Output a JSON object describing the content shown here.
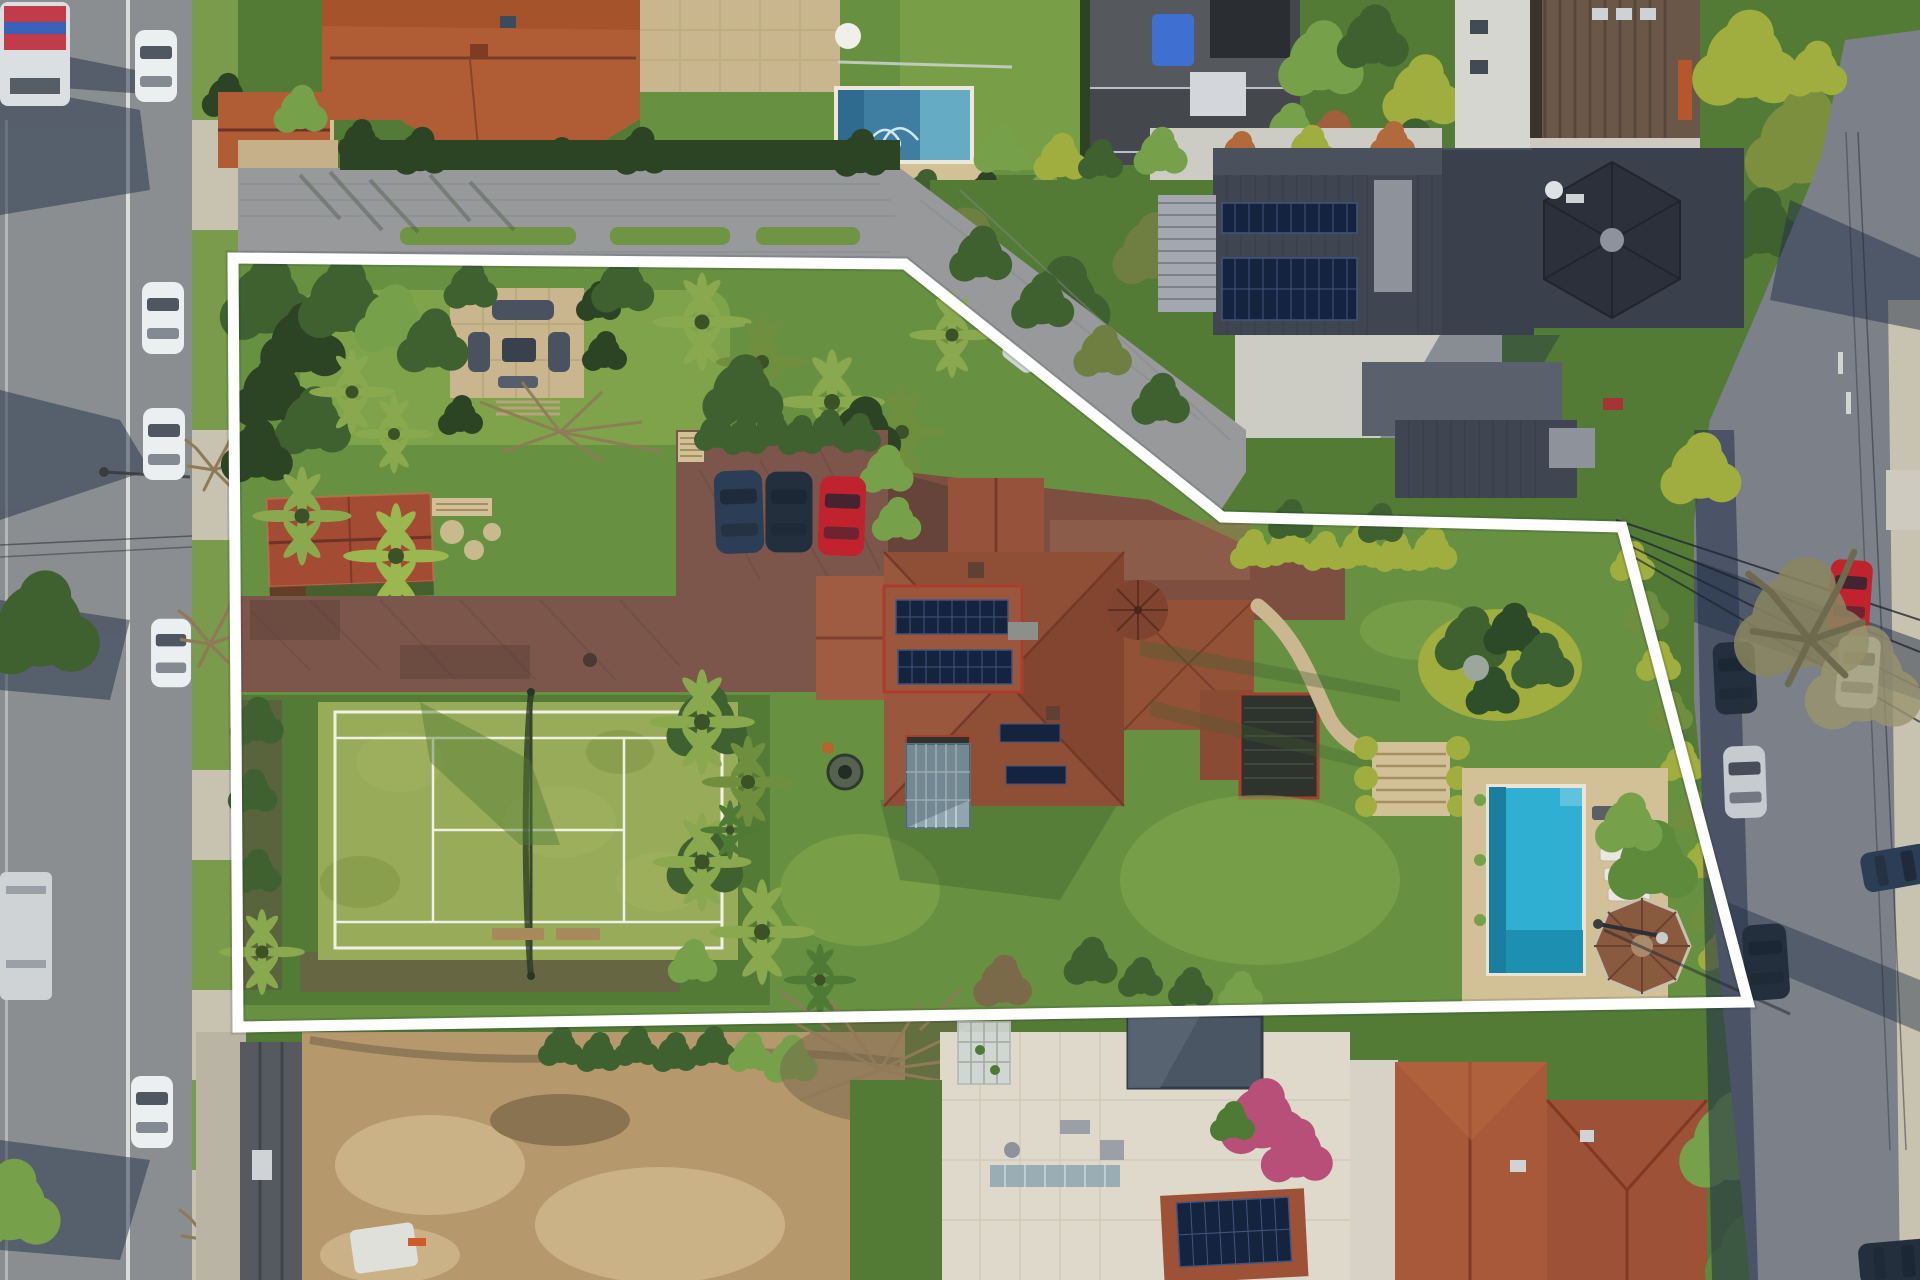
{
  "scene": {
    "type": "aerial-drone-photograph",
    "subject": "large suburban estate with grass tennis court, terracotta-roof mansion, swimming pool and gardens, flanked by streets with parked cars",
    "overlay_meaning": "white outline marking the property boundary"
  },
  "boundary": {
    "points": "233,258 905,264 1222,517 1622,527 1748,1002 238,1027",
    "closed": true,
    "stroke_width": 11
  },
  "features": [
    {
      "name": "front-lawn-patio",
      "desc": "stone patio with grey outdoor lounge furniture on upper lawn"
    },
    {
      "name": "cottage",
      "desc": "small terracotta-roof garden cottage"
    },
    {
      "name": "parking-court",
      "desc": "paved parking with dark blue, black and red cars"
    },
    {
      "name": "tennis-court",
      "desc": "grass tennis court with white lines and net"
    },
    {
      "name": "mansion",
      "desc": "terracotta tiled mansion with rooftop solar arrays, conservatory and dark veranda"
    },
    {
      "name": "estate-pool",
      "desc": "turquoise pool with spa edge, sun loungers and octagonal gazebo"
    },
    {
      "name": "modern-house",
      "desc": "charcoal modern neighbour house with two solar arrays and hexagonal turret"
    },
    {
      "name": "neighbor-pool",
      "desc": "neighbour pool at top of frame"
    },
    {
      "name": "dirt-lot",
      "desc": "cleared sandy lot below the estate"
    },
    {
      "name": "left-road",
      "desc": "street with white parked cars and tree shadows"
    },
    {
      "name": "right-road",
      "desc": "shaded street with parked cars, power lines and street lamp"
    }
  ],
  "palette": {
    "white_line": "#ffffff",
    "asphalt": "#8b8e90",
    "asphalt_dark": "#7b8089",
    "sidewalk": "#c8c2b0",
    "concrete": "#cdccc4",
    "lawn": "#679140",
    "lawn_bright": "#84a74e",
    "lawn_dark": "#537b35",
    "court_grass": "#97ab58",
    "court_line": "#f0f1e6",
    "hedge_dark": "#2d4424",
    "tree_green": "#3f6130",
    "tree_bright": "#76a04a",
    "tree_yellow": "#9fae3e",
    "palm_green": "#8aa84e",
    "terracotta": "#b05d36",
    "terracotta_dark": "#8f4e36",
    "roof_ridge": "#6d3425",
    "cottage_roof": "#a34b33",
    "modern_roof": "#3f4651",
    "modern_roof_light": "#8d929b",
    "turret_roof": "#2b303a",
    "solar": "#16233f",
    "solar_grid": "#41557e",
    "cobble": "#97999a",
    "paver_brown": "#7c564a",
    "paver_dark": "#5c4037",
    "courtyard": "#7d4f40",
    "sandstone": "#d2c096",
    "patio": "#c9b68e",
    "pool_estate": "#2fb0d2",
    "pool_estate_dark": "#1a7e9e",
    "pool_neighbor": "#3f7da1",
    "pool_neighbor_light": "#65abc4",
    "pool_cover": "#4a5663",
    "terrace_white": "#ded9cb",
    "dirt": "#b5996c",
    "dirt_light": "#cbb286",
    "dirt_dark": "#8a7350",
    "veranda": "#2e332e",
    "glass": "#8fa5b0",
    "car_white": "#eceff0",
    "car_red": "#c0222e",
    "car_dark": "#232f3d",
    "car_silver": "#c6cbd0",
    "car_blue": "#2c3e55",
    "bench": "#a8895c",
    "tarp_blue": "#3f6fd0",
    "gazebo_roof": "#8a5a3f",
    "trim_red": "#a5402e",
    "shadow": "#223048",
    "branch": "#8f7a58",
    "bougainvillea": "#b84f78",
    "wire": "#1c232b"
  }
}
